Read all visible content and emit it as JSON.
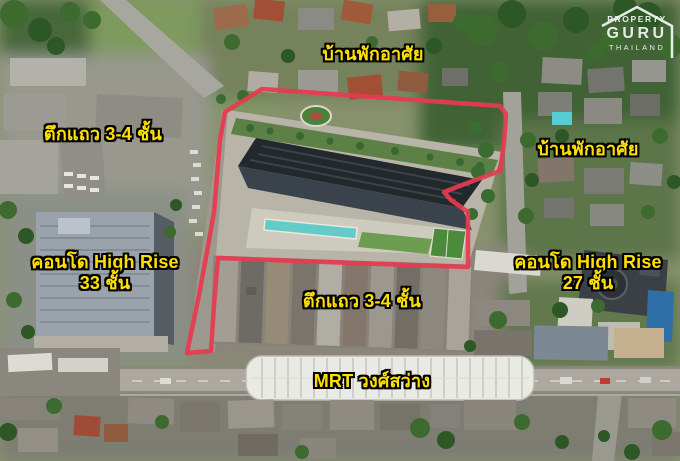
{
  "map": {
    "type": "annotated-aerial-photo",
    "subject": "Condominium project site outlined in red beside MRT Wong Sawang station"
  },
  "watermark": {
    "line1": "PROPERTY",
    "line2": "GURU",
    "line3": "THAILAND"
  },
  "labels": {
    "residential_top": {
      "text": "บ้านพักอาศัย"
    },
    "rowhouse_left": {
      "text": "ตึกแถว 3-4 ชั้น"
    },
    "residential_right": {
      "text": "บ้านพักอาศัย"
    },
    "condo_left": {
      "line1": "คอนโด High Rise",
      "line2": "33 ชั้น"
    },
    "condo_right": {
      "line1": "คอนโด High Rise",
      "line2": "27 ชั้น"
    },
    "rowhouse_center": {
      "text": "ตึกแถว 3-4 ชั้น"
    },
    "mrt": {
      "text": "MRT วงศ์สว่าง"
    }
  },
  "colors": {
    "label_text": "#ffe000",
    "label_outline": "#000000",
    "site_boundary": "#e8394f",
    "watermark": "#ffffff"
  }
}
